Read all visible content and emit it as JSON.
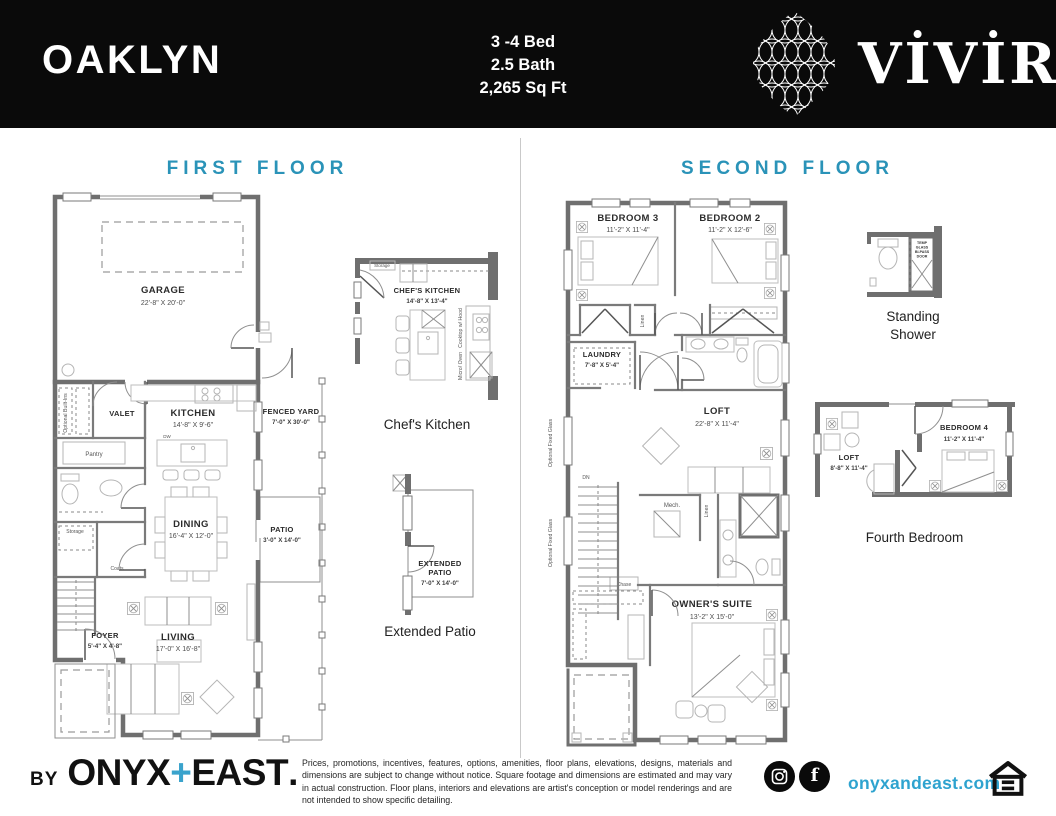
{
  "colors": {
    "accent": "#2a93b8",
    "link": "#2ea3cf",
    "header_bg": "#0a0a0a",
    "wall_gray": "#6f6f6f"
  },
  "header": {
    "plan_name": "OAKLYN",
    "stats": [
      "3 -4 Bed",
      "2.5 Bath",
      "2,265 Sq Ft"
    ],
    "brand": "VİVİR"
  },
  "floors": {
    "first": {
      "title": "FIRST FLOOR",
      "garage": {
        "name": "GARAGE",
        "dims": "22'-8\" X 20'-0\""
      },
      "valet": "VALET",
      "optional_builtins": "Optional Built-Ins",
      "pantry": "Pantry",
      "kitchen": {
        "name": "KITCHEN",
        "dims": "14'-8\" X 9'-6\""
      },
      "dw": "DW",
      "fenced_yard": {
        "name": "FENCED YARD",
        "dims": "7'-0\" X 30'-0\""
      },
      "storage": "Storage",
      "coats": "Coats",
      "dining": {
        "name": "DINING",
        "dims": "16'-4\" X 12'-0\""
      },
      "patio": {
        "name": "PATIO",
        "dims": "3'-0\" X 14'-0\""
      },
      "foyer": {
        "name": "FOYER",
        "dims": "5'-4\" X 4'-8\""
      },
      "living": {
        "name": "LIVING",
        "dims": "17'-0\" X 16'-8\""
      }
    },
    "second": {
      "title": "SECOND FLOOR",
      "bedroom3": {
        "name": "BEDROOM 3",
        "dims": "11'-2\" X 11'-4\""
      },
      "bedroom2": {
        "name": "BEDROOM 2",
        "dims": "11'-2\" X 12'-6\""
      },
      "laundry": {
        "name": "LAUNDRY",
        "dims": "7'-8\" X 5'-4\""
      },
      "linen": "Linen",
      "loft": {
        "name": "LOFT",
        "dims": "22'-8\" X 11'-4\""
      },
      "mech": "Mech.",
      "chase": "Chase",
      "dn": "DN",
      "owners_suite": {
        "name": "OWNER'S SUITE",
        "dims": "13'-2\" X 15'-0\""
      },
      "optional_glass": "Optional Fixed Glass"
    }
  },
  "insets": {
    "chefs_kitchen": {
      "storage": "Storage",
      "name": "CHEF'S KITCHEN",
      "dims": "14'-8\" X 13'-4\"",
      "cooktop": "Cooktop w/ Hood",
      "micro": "Micro/ Oven",
      "caption": "Chef's Kitchen"
    },
    "extended_patio": {
      "name_line1": "EXTENDED",
      "name_line2": "PATIO",
      "dims": "7'-0\" X 14'-0\"",
      "caption": "Extended Patio"
    },
    "standing_shower": {
      "caption": "Standing Shower",
      "note_line1": "TEMP",
      "note_line2": "GLASS",
      "note_line3": "BI-PASS",
      "note_line4": "DOOR"
    },
    "fourth_bedroom": {
      "loft": {
        "name": "LOFT",
        "dims": "8'-8\" X 11'-4\""
      },
      "bedroom4": {
        "name": "BEDROOM 4",
        "dims": "11'-2\" X 11'-4\""
      },
      "caption": "Fourth Bedroom"
    }
  },
  "footer": {
    "by": "BY",
    "brand": {
      "onyx": "ONYX",
      "plus": "+",
      "east": "EAST",
      "dot": "."
    },
    "disclaimer": "Prices, promotions, incentives, features, options, amenities, floor plans, elevations, designs, materials and dimensions are subject to change without notice. Square footage and dimensions are estimated and may vary in actual construction. Floor plans, interiors and elevations are artist's conception or model renderings and are not intended to show specific detailing.",
    "website": "onyxandeast.com",
    "facebook_glyph": "f"
  }
}
